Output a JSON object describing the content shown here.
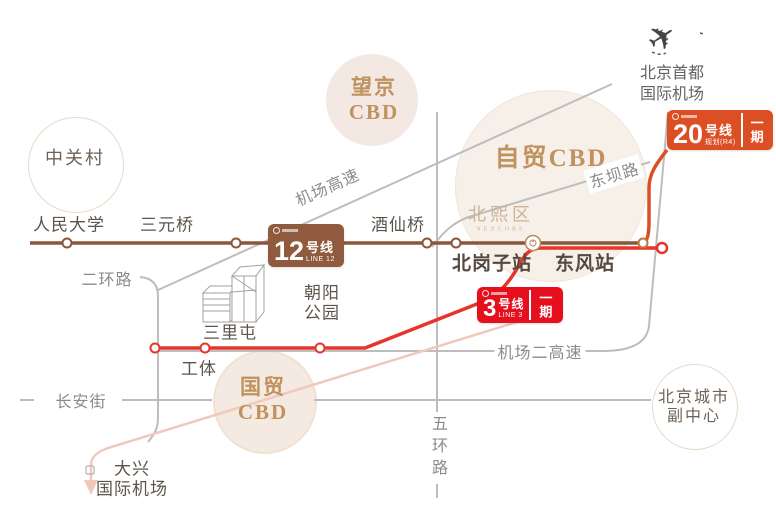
{
  "colors": {
    "line12": "#8a573a",
    "line3": "#e5362c",
    "line20": "#dc4f24",
    "road": "#bdbdbd",
    "planned": "#efc9bc",
    "cbd_text": "#c0925f"
  },
  "lines": {
    "line12": {
      "number": "12",
      "unit": "号线",
      "sub": "LINE 12"
    },
    "line3": {
      "number": "3",
      "unit": "号线",
      "sub": "LINE 3",
      "phase": "一期"
    },
    "line20": {
      "number": "20",
      "unit": "号线",
      "sub": "规划(R4)",
      "phase": "一期"
    }
  },
  "stations": {
    "renmin": "人民大学",
    "sanyuanqiao": "三元桥",
    "jiuxianqiao": "酒仙桥",
    "beigangzi": "北岗子站",
    "dongfeng": "东风站",
    "sanlitun": "三里屯",
    "gongti": "工体",
    "chaoyang_l1": "朝阳",
    "chaoyang_l2": "公园"
  },
  "roads": {
    "airport_expressway": "机场高速",
    "second_ring": "二环路",
    "second_airport_expressway": "机场二高速",
    "changan_avenue": "长安街",
    "fifth_ring": "五环路",
    "dongba_road": "东坝路"
  },
  "areas": {
    "zhongguancun": "中关村",
    "wangjing_l1": "望京",
    "wangjing_l2": "CBD",
    "ftz_cbd": "自贸CBD",
    "guomao_l1": "国贸",
    "guomao_l2": "CBD",
    "subcenter_l1": "北京城市",
    "subcenter_l2": "副中心"
  },
  "airports": {
    "capital_l1": "北京首都",
    "capital_l2": "国际机场",
    "daxing_l1": "大兴",
    "daxing_l2": "国际机场"
  },
  "project": {
    "name": "北熙区",
    "latin": "NEXCORE"
  }
}
